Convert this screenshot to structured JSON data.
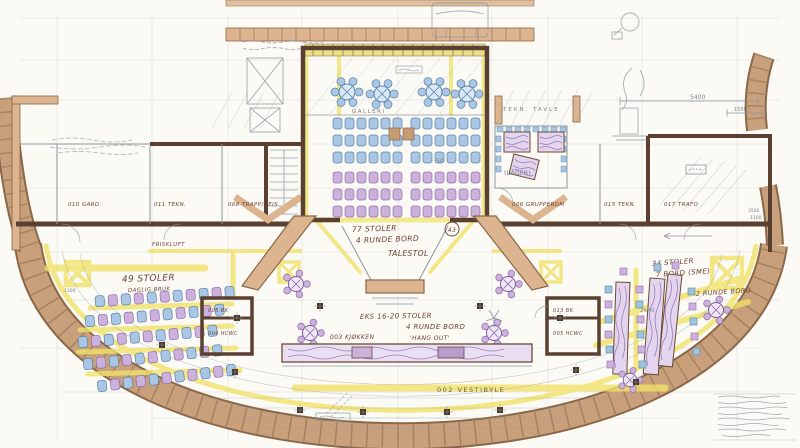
{
  "title": "floor-plan-sketch",
  "labels": {
    "galleri": "GALLERI",
    "aud_seats": "77 STOLER",
    "aud_tables": "4 RUNDE BORD",
    "podium": "TALESTOL",
    "ref": "43",
    "count50": "50",
    "left_title": "49 STOLER",
    "left_sub": "DAGLIG BRUK",
    "flex1": "EKS 16-20 STOLER",
    "flex2": "4 RUNDE BORD",
    "kitchen": "003 KJØKKEN",
    "kitchen_sub": "'HANG OUT'",
    "vestibule": "002 VESTIBYLE",
    "right_title": "34 STOLER",
    "right_sub": "7 BORD (SME)",
    "right_round": "2 RUNDE BORD",
    "lager": "(LAGER)",
    "grupperom": "006 GRUPPEROM",
    "tekn15": "015 TEKN.",
    "trafo": "017 TRAFO",
    "trapp": "008 TRAPP/HEIS",
    "tekn11": "011 TEKN.",
    "gard": "010 GARD.",
    "friskluft": "FRISKLUFT",
    "bk_left": "005 BK",
    "hcwc_left": "004 HCWC",
    "bk_right": "013 BK",
    "hcwc_right": "005 HCWC",
    "tavle": "TEKN. TAVLE"
  },
  "dimensions": {
    "d5400": "5400",
    "d1550": "1550",
    "d3500": "3500",
    "d1100": "1100",
    "d1300": "1300",
    "d2440": "24/40"
  },
  "colors": {
    "paper": "#fbfaf5",
    "wall_brown": "#5a4030",
    "wall_tan": "#dcb48f",
    "stone": "#c8a07b",
    "highlight_yellow": "#f0e26a",
    "chair_blue": "#a9c7e4",
    "chair_purple": "#ccb1dd",
    "pencil": "#8d95a0",
    "ink": "#6e4234"
  }
}
